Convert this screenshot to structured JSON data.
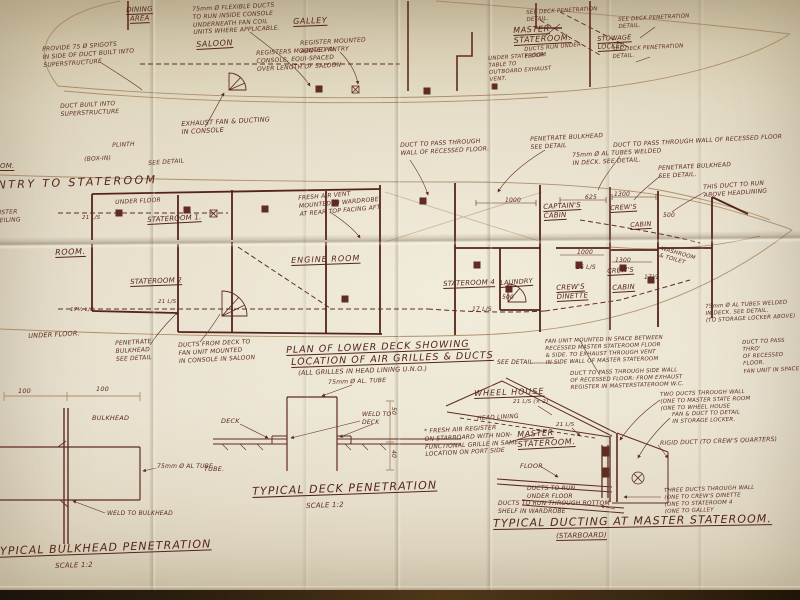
{
  "upper": {
    "flexible_ducts": "75mm Ø FLEXIBLE DUCTS\nTO RUN INSIDE CONSOLE\nUNDERNEATH FAN COIL\nUNITS WHERE APPLICABLE.",
    "saloon": "SALOON",
    "spigots": "PROVIDE 75 Ø SPIGOTS\nIN SIDE OF DUCT BUILT INTO\nSUPERSTRUCTURE",
    "dining": "DINING\nAREA",
    "galley": "GALLEY",
    "register_pantry": "REGISTER MOUNTED\nABOVE PANTRY",
    "registers_console": "REGISTERS MOUNTED IN\nCONSOLE, EQUI-SPACED\nOVER LENGTH OF SALOON",
    "master": "MASTER\nSTATEROOM.",
    "stowage": "STOWAGE\nLOCKER",
    "deck_pen_1": "SEE DECK PENETRATION\nDETAIL.",
    "deck_pen_2": "SEE DECK PENETRATION\nDETAIL.",
    "deck_pen_3": "SEE DECK PENETRATION\nDETAIL.",
    "ducts_run_under": "DUCTS RUN UNDER\nFLOOR.",
    "under_table": "UNDER STATEROOM\nTABLE TO\nOUTBOARD EXHAUST\nVENT.",
    "duct_built": "DUCT BUILT INTO\nSUPERSTRUCTURE",
    "plinth": "PLINTH",
    "box_in": "(BOX-IN)",
    "om": "OM.",
    "exhaust_fan": "EXHAUST FAN & DUCTING\nIN CONSOLE",
    "see_detail": "SEE DETAIL"
  },
  "lower": {
    "header": "ENTRY TO STATEROOM",
    "under_floor_top": "UNDER FLOOR",
    "register_ceiling": "REGISTER\nIN CEILING",
    "stateroom1": "STATEROOM 1.",
    "fresh_air_vent": "FRESH AIR VENT\nMOUNTED IN WARDROBE\nAT REAR TOP FACING AFT",
    "pass_wall_left": "DUCT TO PASS THROUGH\nWALL OF RECESSED FLOOR.",
    "penetrate_mid": "PENETRATE BULKHEAD\nSEE DETAIL",
    "tubes_welded_mid": "75mm Ø AL TUBES WELDED\nIN DECK.  SEE DETAIL.",
    "pass_wall_right": "DUCT TO PASS THROUGH WALL OF RECESSED FLOOR",
    "penetrate_right": "PENETRATE  BULKHEAD\nSEE DETAIL.",
    "run_above_headlining": "THIS DUCT TO RUN\nABOVE HEADLINING",
    "captains_cabin": "CAPTAIN'S\nCABIN",
    "crews_stbd": "CREW'S",
    "crews_stbd2": "CABIN",
    "room_partial": "ROOM.",
    "stateroom2": "STATEROOM 2",
    "engine_room": "ENGINE ROOM",
    "stateroom4": "STATEROOM 4",
    "laundry": "LAUNDRY",
    "crews_dinette": "CREW'S\nDINETTE",
    "crews_port": "CREW'S",
    "crews_port2": "CABIN",
    "washroom": "WASHROOM\n& TOILET",
    "dim_1000a": "1000",
    "dim_625": "625",
    "dim_1300a": "1300",
    "dim_500a": "500",
    "dim_1000b": "1000",
    "dim_26ls": "26 L/S",
    "dim_1300b": "1300",
    "dim_17half": "17½",
    "dim_17ls": "17 L/S",
    "dim_500b": "500",
    "ls_21a": "21 L/S",
    "ls_21b": "21 L/S",
    "ls_17b": "17½ L/S",
    "under_floor_bottom": "UNDER FLOOR.",
    "penetrate3": "PENETRATE\nBULKHEAD\nSEE DETAIL",
    "ducts_console": "DUCTS FROM DECK TO\nFAN UNIT MOUNTED\nIN CONSOLE IN SALOON",
    "fan_unit_note": "FAN UNIT MOUNTED IN SPACE BETWEEN\nRECESSED MASTER STATEROOM FLOOR\n& SIDE. TO EXHAUST THROUGH VENT\nIN SIDE WALL OF MASTER STATEROOM",
    "wc_note": "DUCT TO PASS THROUGH SIDE WALL\nOF RECESSED FLOOR: FROM EXHAUST\nREGISTER IN MASTERSTATEROOM W.C.",
    "corner_note": "DUCT TO PASS THRO'\nOF RECESSED FLOOR.\nFAN UNIT IN SPACE",
    "tubes_locker_note": "75mm Ø AL TUBES WELDED\nIN DECK.  SEE DETAIL.\n(TO STORAGE LOCKER ABOVE)"
  },
  "title_block": {
    "line1": "PLAN OF LOWER DECK SHOWING",
    "line2": "LOCATION OF AIR GRILLES & DUCTS",
    "subtitle": "(ALL GRILLES IN HEAD LINING U.N.O.)",
    "tube_note": "75mm Ø AL. TUBE"
  },
  "bulkhead_detail": {
    "dim_left": "100",
    "dim_right": "100",
    "bulkhead": "BULKHEAD",
    "tube": "75mm Ø AL TUBE",
    "weld": "WELD TO BULKHEAD",
    "title": "TYPICAL BULKHEAD PENETRATION",
    "scale": "SCALE  1:2"
  },
  "deck_detail": {
    "deck": "DECK",
    "weld": "WELD TO\nDECK",
    "dim_top": "50",
    "dim_bottom": "40",
    "tube": "TUBE.",
    "title": "TYPICAL DECK PENETRATION",
    "scale": "SCALE  1:2"
  },
  "master_detail": {
    "see_detail": "SEE DETAIL",
    "wheelhouse": "WHEEL HOUSE",
    "head_lining": "HEAD LINING",
    "rate_x2": "21 L/S (× 2)",
    "rate_b": "21 L/S",
    "master": "MASTER\nSTATEROOM.",
    "floor": "FLOOR",
    "fresh_air": "* FRESH AIR REGISTER\nON STARBOARD WITH NON-\nFUNCTIONAL GRILLE IN SAME\nLOCATION ON PORT SIDE",
    "two_ducts": "TWO DUCTS THROUGH WALL\n(ONE TO MASTER STATE ROOM\n(ONE TO WHEEL HOUSE",
    "fan_duct": "FAN & DUCT TO DETAIL\nIN STORAGE LOCKER.",
    "rigid": "RIGID DUCT (TO CREW'S QUARTERS)",
    "ducts_under": "DUCTS TO RUN\nUNDER FLOOR",
    "ducts_shelf": "DUCTS TO RUN THROUGH BOTTOM\nSHELF IN WARDROBE",
    "three_ducts": "THREE DUCTS THROUGH WALL\n(ONE TO CREW'S DINETTE\n(ONE TO STATEROOM 4\n(ONE TO GALLEY",
    "title": "TYPICAL DUCTING AT MASTER STATEROOM.",
    "subtitle": "(STARBOARD)"
  }
}
